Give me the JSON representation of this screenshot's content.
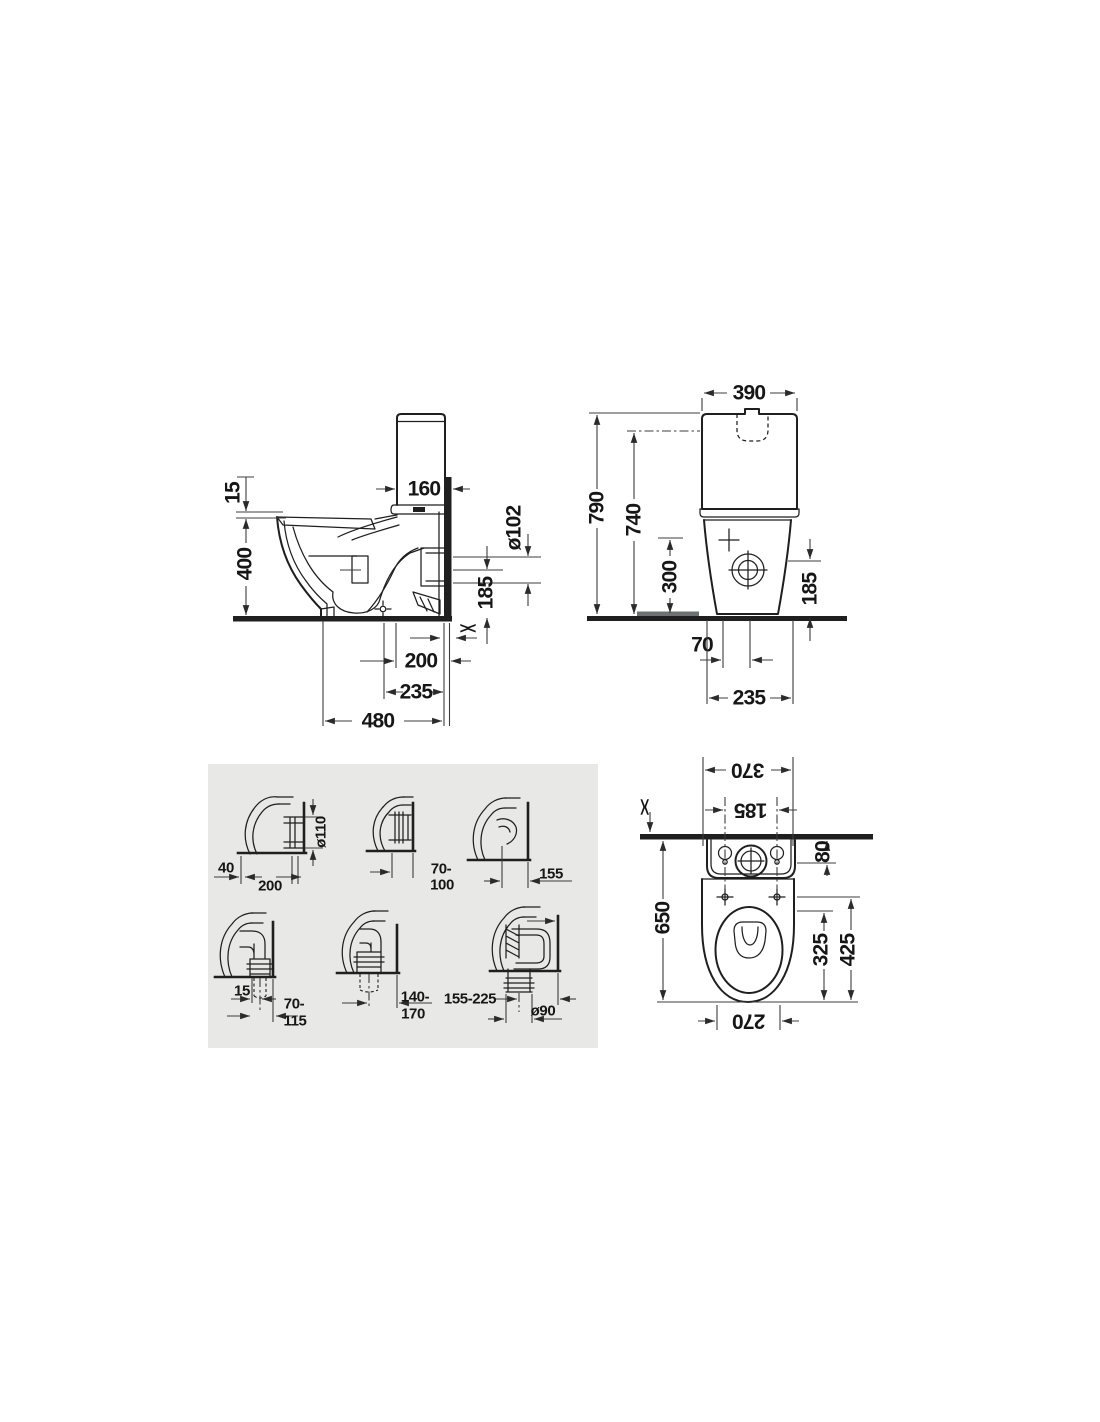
{
  "side_view": {
    "seat_offset": "15",
    "rim_height": "400",
    "tank_depth": "160",
    "outlet_diameter": "ø102",
    "outlet_height": "185",
    "outlet_center_from_wall": "200",
    "rough_in": "235",
    "total_depth": "480",
    "wall_gap_symbol": "><"
  },
  "front_view": {
    "tank_width": "390",
    "total_height": "790",
    "tank_top_height": "740",
    "supply_height": "300",
    "outlet_height": "185",
    "supply_offset": "70",
    "base_width": "235"
  },
  "top_view": {
    "back_width": "370",
    "fixing_hole_spacing": "185",
    "wall_gap_symbol": "><",
    "tank_overhang": "80",
    "total_depth": "650",
    "seat_inner_depth": "325",
    "hinge_to_front": "425",
    "front_width": "270"
  },
  "outlet_variants": {
    "horizontal_wall_outlet": {
      "pipe_diameter": "ø110",
      "offset": "40",
      "depth": "200"
    },
    "horizontal_outlet_range": {
      "range_top": "70-",
      "range_bottom": "100"
    },
    "horizontal_outlet_short": {
      "depth": "155"
    },
    "vertical_outlet_elbow": {
      "offset": "15",
      "range_top": "70-",
      "range_bottom": "115"
    },
    "vertical_outlet_mid": {
      "range_top": "140-",
      "range_bottom": "170"
    },
    "vertical_outlet_trap": {
      "range": "155-225",
      "pipe_diameter": "ø90"
    }
  },
  "colors": {
    "line": "#1f1f1f",
    "dim": "#3c3c3c",
    "text": "#161616",
    "panel": "#e8e8e6",
    "strip": "#6e7272"
  }
}
